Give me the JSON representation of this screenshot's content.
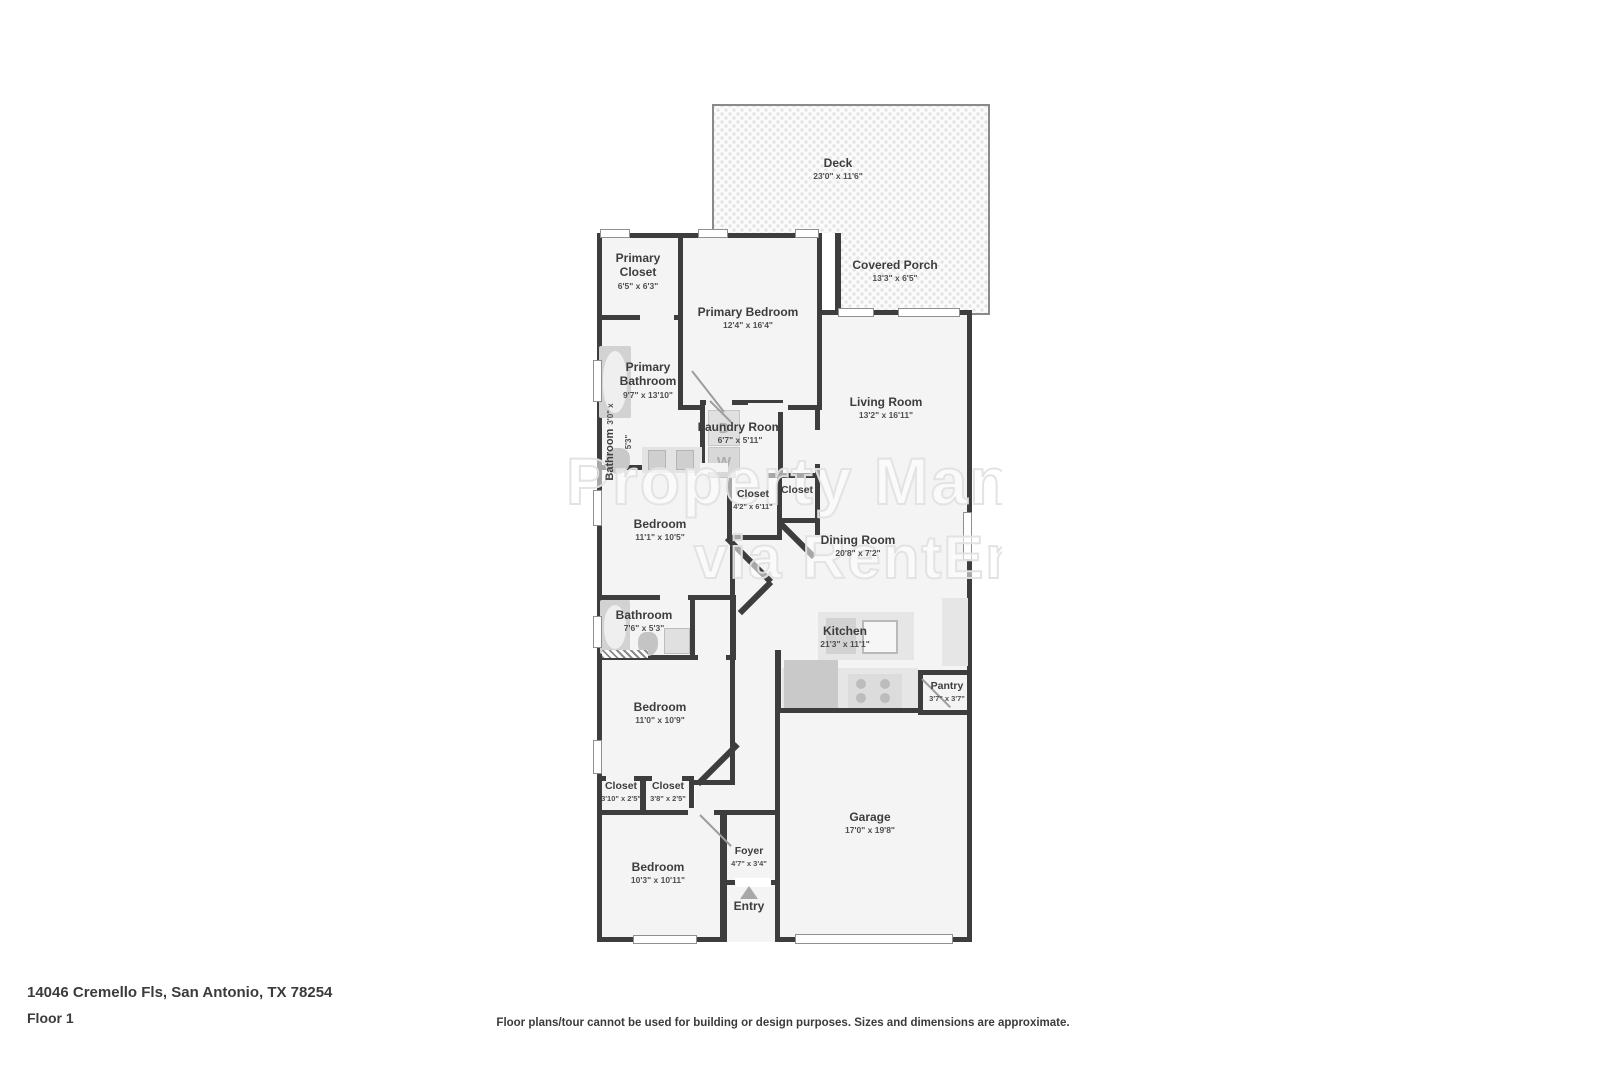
{
  "page": {
    "address": "14046 Cremello Fls, San Antonio, TX 78254",
    "floor_label": "Floor 1",
    "disclaimer": "Floor plans/tour cannot be used for building or design purposes. Sizes and dimensions are approximate."
  },
  "watermark": {
    "line1": "Property Man",
    "line2": "via RentEngi"
  },
  "appliances": {
    "dryer": "D",
    "washer": "W"
  },
  "entry_label": "Entry",
  "rooms": [
    {
      "name": "Deck",
      "dims": "23'0\" x 11'6\""
    },
    {
      "name": "Covered Porch",
      "dims": "13'3\" x 6'5\""
    },
    {
      "name": "Primary Closet",
      "dims": "6'5\" x 6'3\""
    },
    {
      "name": "Primary Bedroom",
      "dims": "12'4\" x 16'4\""
    },
    {
      "name": "Primary Bathroom",
      "dims": "9'7\" x 13'10\""
    },
    {
      "name": "Bathroom",
      "dims": "3'0\" x 5'3\""
    },
    {
      "name": "Laundry Room",
      "dims": "6'7\" x 5'11\""
    },
    {
      "name": "Living Room",
      "dims": "13'2\" x 16'11\""
    },
    {
      "name": "Closet",
      "dims": "4'2\" x 6'11\""
    },
    {
      "name": "Closet",
      "dims": ""
    },
    {
      "name": "Bedroom",
      "dims": "11'1\" x 10'5\""
    },
    {
      "name": "Dining Room",
      "dims": "20'8\" x 7'2\""
    },
    {
      "name": "Bathroom",
      "dims": "7'6\" x 5'3\""
    },
    {
      "name": "Kitchen",
      "dims": "21'3\" x 11'1\""
    },
    {
      "name": "Bedroom",
      "dims": "11'0\" x 10'9\""
    },
    {
      "name": "Pantry",
      "dims": "3'7\" x 3'7\""
    },
    {
      "name": "Closet",
      "dims": "3'10\" x 2'5\""
    },
    {
      "name": "Closet",
      "dims": "3'8\" x 2'5\""
    },
    {
      "name": "Bedroom",
      "dims": "10'3\" x 10'11\""
    },
    {
      "name": "Foyer",
      "dims": "4'7\" x 3'4\""
    },
    {
      "name": "Garage",
      "dims": "17'0\" x 19'8\""
    },
    {
      "name": "Entry",
      "dims": ""
    }
  ]
}
